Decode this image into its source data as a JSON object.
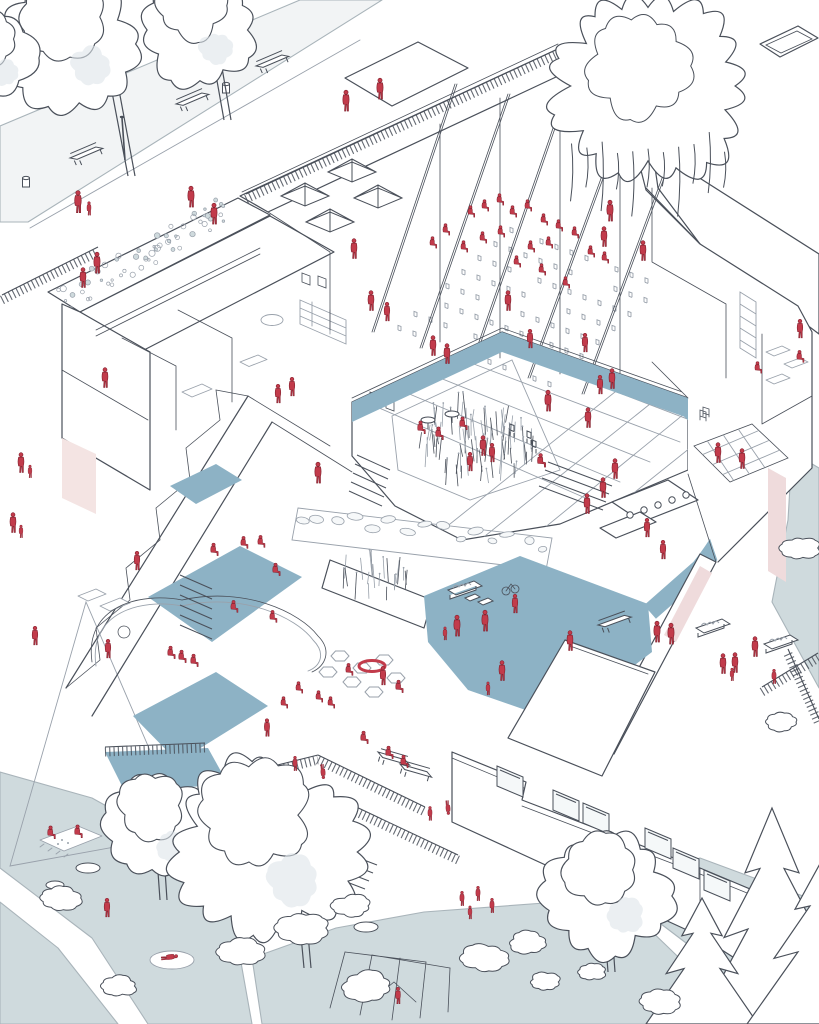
{
  "illustration": {
    "subject": "axonometric cutaway illustration of a school building with park, courtyard and playground",
    "people_are_shown_in": "red silhouettes"
  },
  "palette": {
    "line": "#4a505a",
    "line_light": "#99a1ab",
    "figure_red": "#c23b4b",
    "figure_dark": "#84222f",
    "floor_blue": "#8db2c5",
    "ground_blue": "#cfdadd",
    "glass": "#dde5ea",
    "pink": "#f4e4e3",
    "pink_panel": "#efdbdc",
    "paving": "#e9edef",
    "rug_blue": "#b9cdd9",
    "stone": "#f1f4f5",
    "path_grey": "#f2f4f5",
    "greenroof": "#eef2f0"
  },
  "scene": {
    "figures": [
      [
        78,
        201,
        1,
        "st"
      ],
      [
        89,
        208,
        0.62,
        "st"
      ],
      [
        191,
        196,
        0.95,
        "st"
      ],
      [
        214,
        213,
        0.95,
        "st"
      ],
      [
        97,
        262,
        0.95,
        "st"
      ],
      [
        83,
        277,
        0.9,
        "st"
      ],
      [
        346,
        100,
        0.95,
        "st"
      ],
      [
        380,
        88,
        0.95,
        "st"
      ],
      [
        610,
        210,
        0.95,
        "st"
      ],
      [
        604,
        236,
        0.9,
        "st"
      ],
      [
        354,
        248,
        0.9,
        "st"
      ],
      [
        371,
        300,
        0.9,
        "st"
      ],
      [
        387,
        311,
        0.85,
        "st"
      ],
      [
        470,
        212,
        0.72,
        "si"
      ],
      [
        484,
        206,
        0.72,
        "si"
      ],
      [
        499,
        200,
        0.72,
        "si"
      ],
      [
        512,
        212,
        0.72,
        "si"
      ],
      [
        527,
        206,
        0.72,
        "si"
      ],
      [
        543,
        220,
        0.72,
        "si"
      ],
      [
        558,
        226,
        0.72,
        "si"
      ],
      [
        574,
        233,
        0.72,
        "si"
      ],
      [
        590,
        252,
        0.72,
        "si"
      ],
      [
        604,
        258,
        0.72,
        "si"
      ],
      [
        548,
        243,
        0.72,
        "si"
      ],
      [
        530,
        247,
        0.72,
        "si"
      ],
      [
        500,
        232,
        0.72,
        "si"
      ],
      [
        482,
        238,
        0.72,
        "si"
      ],
      [
        463,
        247,
        0.72,
        "si"
      ],
      [
        516,
        262,
        0.72,
        "si"
      ],
      [
        541,
        270,
        0.72,
        "si"
      ],
      [
        565,
        283,
        0.72,
        "si"
      ],
      [
        445,
        230,
        0.72,
        "si"
      ],
      [
        432,
        243,
        0.72,
        "si"
      ],
      [
        508,
        300,
        0.9,
        "st"
      ],
      [
        643,
        250,
        0.9,
        "st"
      ],
      [
        105,
        377,
        0.9,
        "st"
      ],
      [
        278,
        393,
        0.85,
        "st"
      ],
      [
        292,
        386,
        0.85,
        "st"
      ],
      [
        318,
        472,
        0.95,
        "st"
      ],
      [
        21,
        462,
        0.9,
        "st"
      ],
      [
        30,
        471,
        0.58,
        "st"
      ],
      [
        13,
        522,
        0.9,
        "st"
      ],
      [
        21,
        531,
        0.58,
        "st"
      ],
      [
        433,
        345,
        0.9,
        "st"
      ],
      [
        447,
        353,
        0.9,
        "st"
      ],
      [
        530,
        338,
        0.85,
        "st"
      ],
      [
        585,
        342,
        0.85,
        "st"
      ],
      [
        420,
        428,
        0.8,
        "si"
      ],
      [
        462,
        424,
        0.8,
        "si"
      ],
      [
        438,
        434,
        0.8,
        "si"
      ],
      [
        483,
        445,
        0.9,
        "st"
      ],
      [
        492,
        452,
        0.85,
        "st"
      ],
      [
        470,
        461,
        0.85,
        "st"
      ],
      [
        540,
        461,
        0.85,
        "si"
      ],
      [
        548,
        400,
        0.95,
        "st"
      ],
      [
        588,
        417,
        0.9,
        "st"
      ],
      [
        612,
        378,
        0.9,
        "st"
      ],
      [
        600,
        384,
        0.85,
        "st"
      ],
      [
        615,
        468,
        0.9,
        "st"
      ],
      [
        603,
        487,
        0.9,
        "st"
      ],
      [
        587,
        503,
        0.9,
        "st"
      ],
      [
        800,
        328,
        0.85,
        "st"
      ],
      [
        799,
        357,
        0.75,
        "si"
      ],
      [
        757,
        368,
        0.72,
        "si"
      ],
      [
        718,
        452,
        0.9,
        "st"
      ],
      [
        742,
        458,
        0.9,
        "st"
      ],
      [
        647,
        527,
        0.85,
        "st"
      ],
      [
        663,
        549,
        0.85,
        "st"
      ],
      [
        657,
        631,
        0.95,
        "st"
      ],
      [
        671,
        633,
        0.95,
        "st"
      ],
      [
        755,
        646,
        0.9,
        "st"
      ],
      [
        723,
        663,
        0.9,
        "st"
      ],
      [
        735,
        662,
        0.9,
        "st"
      ],
      [
        732,
        674,
        0.58,
        "st"
      ],
      [
        774,
        676,
        0.66,
        "st"
      ],
      [
        137,
        560,
        0.85,
        "st"
      ],
      [
        213,
        550,
        0.78,
        "si"
      ],
      [
        243,
        543,
        0.75,
        "si"
      ],
      [
        260,
        542,
        0.75,
        "si"
      ],
      [
        275,
        570,
        0.78,
        "si"
      ],
      [
        233,
        607,
        0.75,
        "si"
      ],
      [
        272,
        617,
        0.75,
        "si"
      ],
      [
        170,
        653,
        0.78,
        "si"
      ],
      [
        181,
        657,
        0.78,
        "si"
      ],
      [
        193,
        661,
        0.78,
        "si"
      ],
      [
        108,
        648,
        0.85,
        "st"
      ],
      [
        35,
        635,
        0.85,
        "st"
      ],
      [
        348,
        670,
        0.75,
        "si"
      ],
      [
        383,
        675,
        0.85,
        "st"
      ],
      [
        398,
        687,
        0.78,
        "si"
      ],
      [
        330,
        703,
        0.72,
        "si"
      ],
      [
        318,
        697,
        0.72,
        "si"
      ],
      [
        298,
        688,
        0.72,
        "si"
      ],
      [
        283,
        703,
        0.72,
        "si"
      ],
      [
        267,
        727,
        0.8,
        "st"
      ],
      [
        295,
        763,
        0.66,
        "st"
      ],
      [
        323,
        772,
        0.66,
        "hs"
      ],
      [
        430,
        813,
        0.64,
        "st"
      ],
      [
        448,
        808,
        0.64,
        "hs"
      ],
      [
        363,
        738,
        0.78,
        "si"
      ],
      [
        388,
        753,
        0.78,
        "si"
      ],
      [
        403,
        762,
        0.78,
        "si"
      ],
      [
        457,
        625,
        0.95,
        "st"
      ],
      [
        445,
        633,
        0.6,
        "st"
      ],
      [
        485,
        620,
        0.95,
        "st"
      ],
      [
        515,
        603,
        0.85,
        "st"
      ],
      [
        502,
        670,
        0.9,
        "st"
      ],
      [
        488,
        688,
        0.6,
        "st"
      ],
      [
        570,
        640,
        0.9,
        "st"
      ],
      [
        462,
        898,
        0.66,
        "st"
      ],
      [
        478,
        893,
        0.66,
        "st"
      ],
      [
        492,
        905,
        0.66,
        "st"
      ],
      [
        470,
        912,
        0.6,
        "st"
      ],
      [
        50,
        833,
        0.8,
        "si"
      ],
      [
        77,
        832,
        0.8,
        "si"
      ],
      [
        107,
        907,
        0.85,
        "st"
      ],
      [
        170,
        957,
        0.75,
        "ly"
      ],
      [
        398,
        995,
        0.75,
        "st"
      ]
    ],
    "trees_deciduous": [
      {
        "cx": 72,
        "cy": 44,
        "r": 60,
        "trunk": [
          112,
          92,
          128,
          176
        ]
      },
      {
        "cx": 200,
        "cy": 30,
        "r": 54,
        "trunk": [
          214,
          64,
          224,
          120
        ]
      },
      {
        "cx": -8,
        "cy": 58,
        "r": 42,
        "trunk": null
      },
      {
        "cx": 158,
        "cy": 828,
        "r": 50,
        "trunk": [
          158,
          872,
          160,
          900
        ]
      },
      {
        "cx": 268,
        "cy": 852,
        "r": 82,
        "trunk": [
          300,
          925,
          304,
          968
        ]
      },
      {
        "cx": 608,
        "cy": 896,
        "r": 58,
        "trunk": [
          606,
          946,
          608,
          972
        ]
      }
    ],
    "willow": {
      "cx": 648,
      "cy": 86,
      "r": 90
    },
    "pines": [
      {
        "cx": 772,
        "top": 808,
        "w": 150,
        "h": 216
      },
      {
        "cx": 702,
        "top": 898,
        "w": 112,
        "h": 126
      },
      {
        "cx": 822,
        "top": 860,
        "w": 150,
        "h": 164
      }
    ],
    "bushes": [
      {
        "cx": 60,
        "cy": 898,
        "r": 20
      },
      {
        "cx": 120,
        "cy": 986,
        "r": 16
      },
      {
        "cx": 485,
        "cy": 958,
        "r": 22
      },
      {
        "cx": 545,
        "cy": 982,
        "r": 15
      },
      {
        "cx": 592,
        "cy": 972,
        "r": 13
      },
      {
        "cx": 660,
        "cy": 1002,
        "r": 18
      },
      {
        "cx": 302,
        "cy": 928,
        "r": 26
      },
      {
        "cx": 352,
        "cy": 906,
        "r": 18
      },
      {
        "cx": 368,
        "cy": 986,
        "r": 24
      },
      {
        "cx": 800,
        "cy": 548,
        "r": 18
      },
      {
        "cx": 782,
        "cy": 722,
        "r": 15
      },
      {
        "cx": 528,
        "cy": 942,
        "r": 18
      },
      {
        "cx": 240,
        "cy": 952,
        "r": 22
      }
    ],
    "benches": [
      {
        "x": 176,
        "y": 104,
        "r": -23
      },
      {
        "x": 70,
        "y": 158,
        "r": -23
      },
      {
        "x": 256,
        "y": 66,
        "r": -23
      },
      {
        "x": 598,
        "y": 625,
        "r": -20
      },
      {
        "x": 378,
        "y": 752,
        "r": 16
      },
      {
        "x": 400,
        "y": 764,
        "r": 16
      }
    ],
    "planters": [
      {
        "x": 696,
        "y": 628
      },
      {
        "x": 764,
        "y": 644
      },
      {
        "x": 448,
        "y": 590
      }
    ],
    "bins": [
      {
        "x": 226,
        "y": 84
      },
      {
        "x": 26,
        "y": 178
      }
    ],
    "lamps": [
      {
        "x": 122,
        "y": 118
      }
    ],
    "skylights": [
      {
        "x": 281,
        "y": 196
      },
      {
        "x": 328,
        "y": 172
      },
      {
        "x": 306,
        "y": 222
      },
      {
        "x": 354,
        "y": 198
      }
    ],
    "auditorium_seating": {
      "origin": [
        398,
        330
      ],
      "row_step": [
        16,
        -14
      ],
      "col_step": [
        15,
        5.6
      ],
      "rows": 8,
      "cols": 11
    },
    "reed_bed": {
      "cx": 472,
      "cy": 452,
      "rx": 62,
      "ry": 40,
      "count": 80
    },
    "planter_reeds": {
      "cx": 372,
      "cy": 588,
      "rx": 40,
      "ry": 14,
      "count": 22
    },
    "green_roof_band": {
      "from": [
        62,
        298
      ],
      "to": [
        232,
        207
      ],
      "halfwidth": 14,
      "count": 60
    },
    "stone_wall": {
      "from": [
        302,
        514
      ],
      "to": [
        544,
        544
      ],
      "count": 15
    },
    "railings": [
      [
        246,
        199,
        562,
        52
      ],
      [
        2,
        300,
        98,
        252
      ],
      [
        205,
        788,
        318,
        760
      ],
      [
        318,
        760,
        425,
        812
      ],
      [
        248,
        840,
        352,
        810
      ],
      [
        352,
        810,
        458,
        860
      ],
      [
        762,
        692,
        818,
        658
      ],
      [
        788,
        654,
        819,
        724
      ],
      [
        105,
        752,
        205,
        748
      ]
    ],
    "stairs": [
      {
        "x": 548,
        "y": 462,
        "dx": 64,
        "dy": 24,
        "n": 4,
        "sx": -3,
        "sy": 8
      },
      {
        "x": 180,
        "y": 575,
        "dx": 32,
        "dy": 14,
        "n": 6,
        "sx": 0,
        "sy": 10
      },
      {
        "x": 357,
        "y": 455,
        "dx": 33,
        "dy": 15,
        "n": 5,
        "sx": -2,
        "sy": 9
      },
      {
        "x": 325,
        "y": 845,
        "dx": 52,
        "dy": 20,
        "n": 6,
        "sx": -4,
        "sy": 8
      }
    ],
    "hex_cushions": [
      [
        340,
        656
      ],
      [
        362,
        668
      ],
      [
        384,
        660
      ],
      [
        352,
        682
      ],
      [
        374,
        692
      ],
      [
        396,
        678
      ],
      [
        328,
        672
      ]
    ],
    "courtyard_tables": [
      [
        428,
        420
      ],
      [
        452,
        414
      ]
    ],
    "courtyard_chairs": [
      [
        510,
        430
      ],
      [
        527,
        437
      ],
      [
        532,
        446
      ]
    ],
    "kitchen_stools": [
      [
        630,
        515
      ],
      [
        644,
        510
      ],
      [
        658,
        505
      ],
      [
        672,
        500
      ],
      [
        686,
        495
      ]
    ],
    "neighbor_windows": [
      [
        497,
        766
      ],
      [
        553,
        790
      ],
      [
        583,
        803
      ],
      [
        645,
        828
      ],
      [
        673,
        848
      ],
      [
        704,
        870
      ],
      [
        752,
        896
      ]
    ],
    "stepping_stones": [
      [
        318,
        905,
        20,
        8
      ],
      [
        366,
        927,
        12,
        5
      ],
      [
        88,
        868,
        12,
        5
      ],
      [
        55,
        885,
        9,
        4
      ]
    ],
    "toy_cars": [
      [
        465,
        598
      ],
      [
        478,
        602
      ]
    ],
    "bicycle": {
      "x": 510,
      "y": 588
    }
  }
}
